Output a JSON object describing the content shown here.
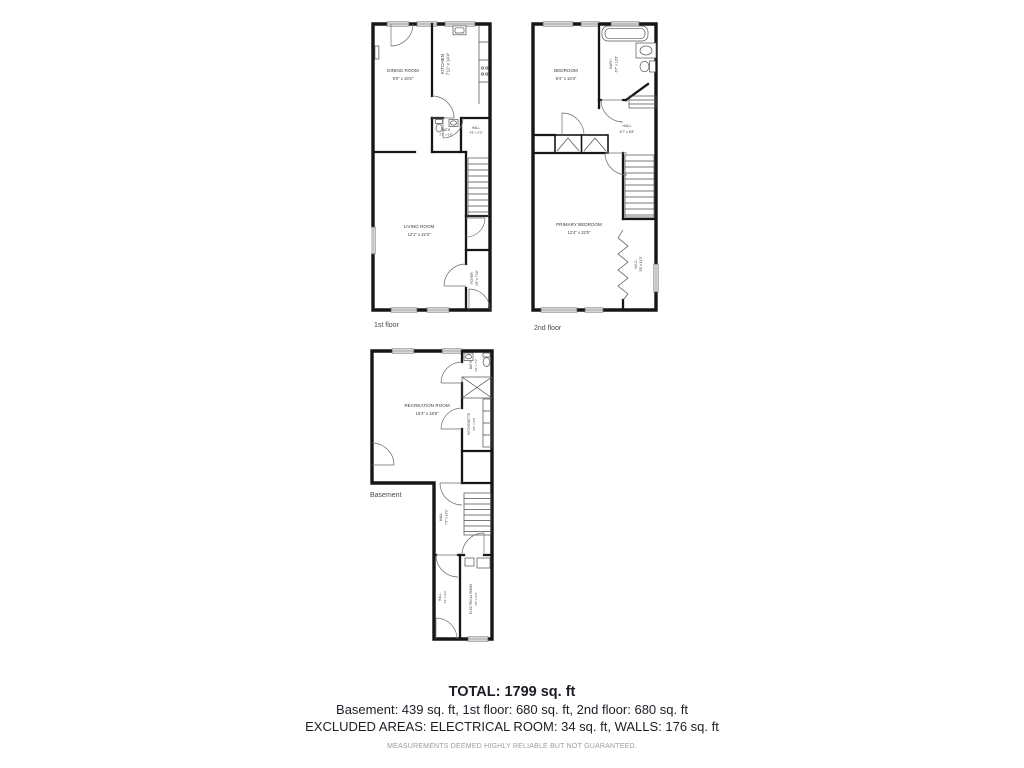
{
  "floors": {
    "first": {
      "label": "1st floor",
      "rooms": {
        "dining": {
          "name": "DINING ROOM",
          "dims": "9'0\" x 19'2\""
        },
        "kitchen": {
          "name": "KITCHEN",
          "dims": "7'11\" x 14'4\""
        },
        "bath": {
          "name": "BATH",
          "dims": "2'1\" x 6'6\""
        },
        "hall": {
          "name": "HALL",
          "dims": "4'8\" x 6'0\""
        },
        "living": {
          "name": "LIVING ROOM",
          "dims": "12'1\" x 22'3\""
        },
        "foyer": {
          "name": "FOYER",
          "dims": "4'8\" x 7'10\""
        }
      }
    },
    "second": {
      "label": "2nd floor",
      "rooms": {
        "bedroom": {
          "name": "BEDROOM",
          "dims": "9'4\" x 16'3\""
        },
        "bath": {
          "name": "BATH",
          "dims": "6'7\" x 12'6\""
        },
        "hall": {
          "name": "HALL",
          "dims": "6'7\" x 6'8\""
        },
        "primary": {
          "name": "PRIMARY BEDROOM",
          "dims": "12'4\" x 22'5\""
        },
        "wic": {
          "name": "W.I.C.",
          "dims": "3'8\" x 11'3\""
        }
      }
    },
    "basement": {
      "label": "Basement",
      "rooms": {
        "recreation": {
          "name": "RECREATION ROOM",
          "dims": "16'3\" x 18'8\""
        },
        "bath": {
          "name": "BATH",
          "dims": "3'5\" x 7'2\""
        },
        "kitchenette": {
          "name": "KITCHENETTE",
          "dims": "6'8\" x 5'8\""
        },
        "hall_upper": {
          "name": "HALL",
          "dims": "7'3\" x 13'1\""
        },
        "hall_lower": {
          "name": "HALL",
          "dims": "3'4\" x 9'3\""
        },
        "electrical": {
          "name": "ELECTRICAL ROOM",
          "dims": "3'8\" x 9'3\""
        }
      }
    }
  },
  "summary": {
    "total": "TOTAL: 1799 sq. ft",
    "floors_line": "Basement: 439 sq. ft, 1st floor: 680 sq. ft, 2nd floor: 680 sq. ft",
    "excluded_line": "EXCLUDED AREAS: ELECTRICAL ROOM: 34 sq. ft, WALLS: 176 sq. ft",
    "disclaimer": "MEASUREMENTS DEEMED HIGHLY RELIABLE BUT NOT GUARANTEED."
  },
  "colors": {
    "wall": "#161616",
    "text": "#3d3d3d",
    "summary_text": "#1d1d25",
    "disclaimer": "#9b9b9b"
  }
}
